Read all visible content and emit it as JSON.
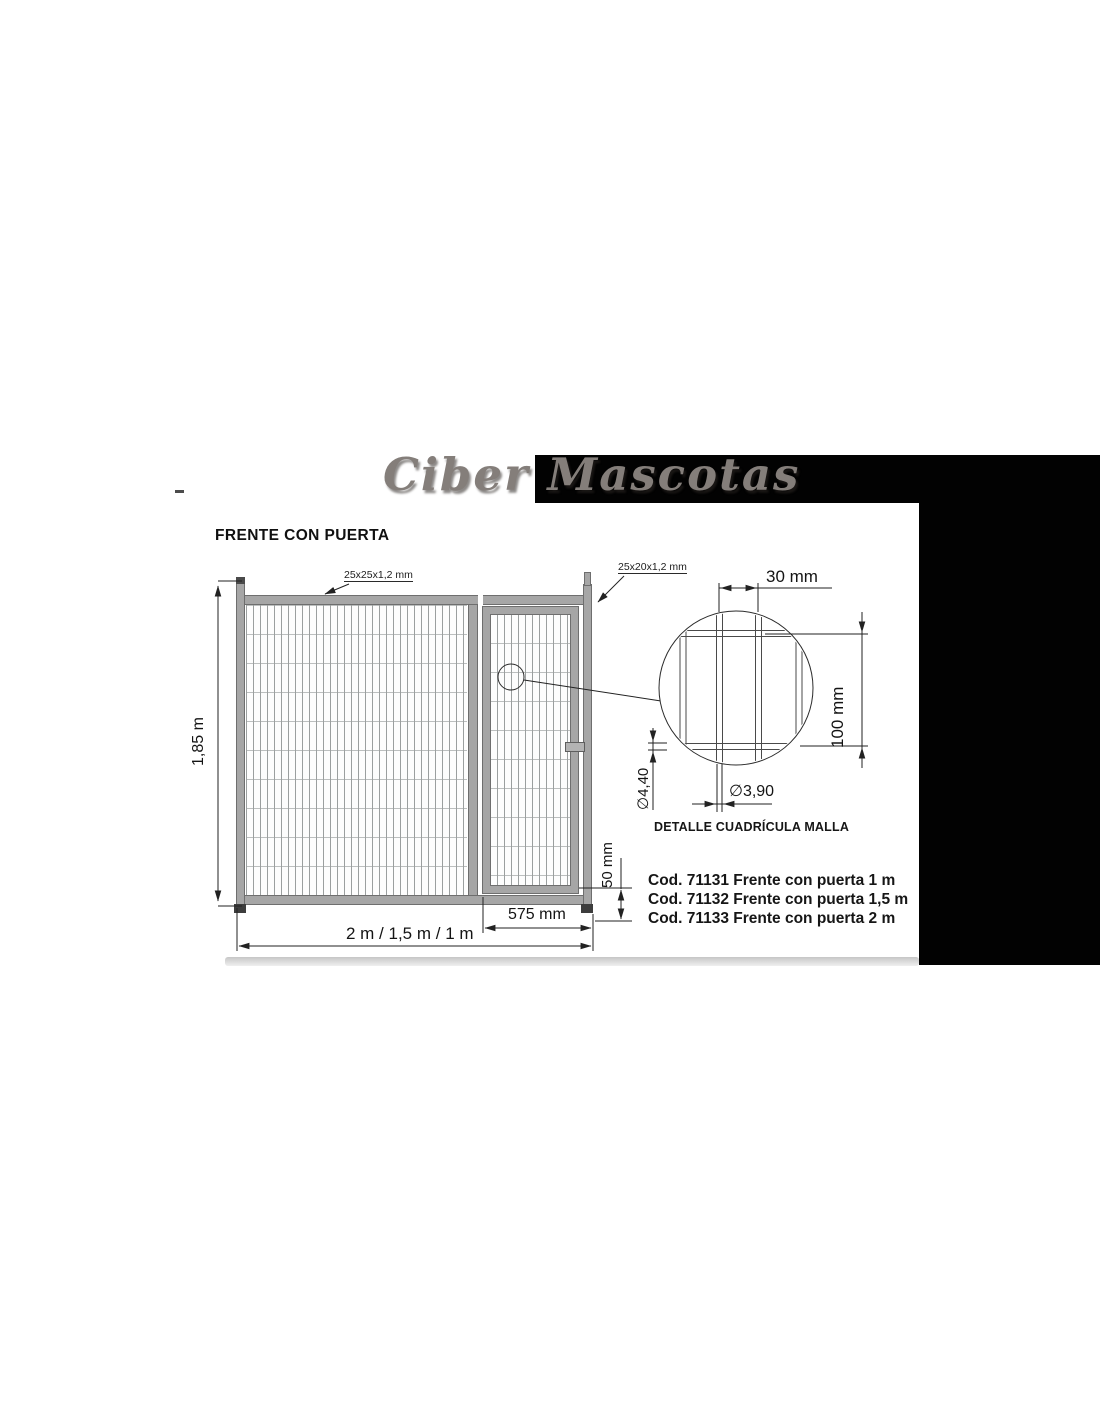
{
  "page": {
    "logo_text": "Ciber Mascotas",
    "title": "FRENTE CON PUERTA"
  },
  "diagram": {
    "frame_profiles": {
      "main": "25x25x1,2 mm",
      "door": "25x20x1,2 mm"
    },
    "dimensions": {
      "panel_height": "1,85 m",
      "panel_width_options": "2 m / 1,5 m / 1 m",
      "door_width": "575 mm",
      "bottom_gap": "50 mm",
      "mesh_cell_width": "30 mm",
      "mesh_cell_height": "100 mm",
      "wire_diameter_horizontal": "∅4,40",
      "wire_diameter_vertical": "∅3,90"
    },
    "detail_caption": "DETALLE CUADRÍCULA MALLA"
  },
  "products": [
    {
      "label": "Cod. 71131 Frente con puerta 1 m"
    },
    {
      "label": "Cod. 71132 Frente con puerta 1,5 m"
    },
    {
      "label": "Cod. 71133 Frente con puerta 2 m"
    }
  ],
  "colors": {
    "frame_gray": "#a6a6a6",
    "panel_black": "#020202",
    "logo_gray": "#847e7a"
  }
}
